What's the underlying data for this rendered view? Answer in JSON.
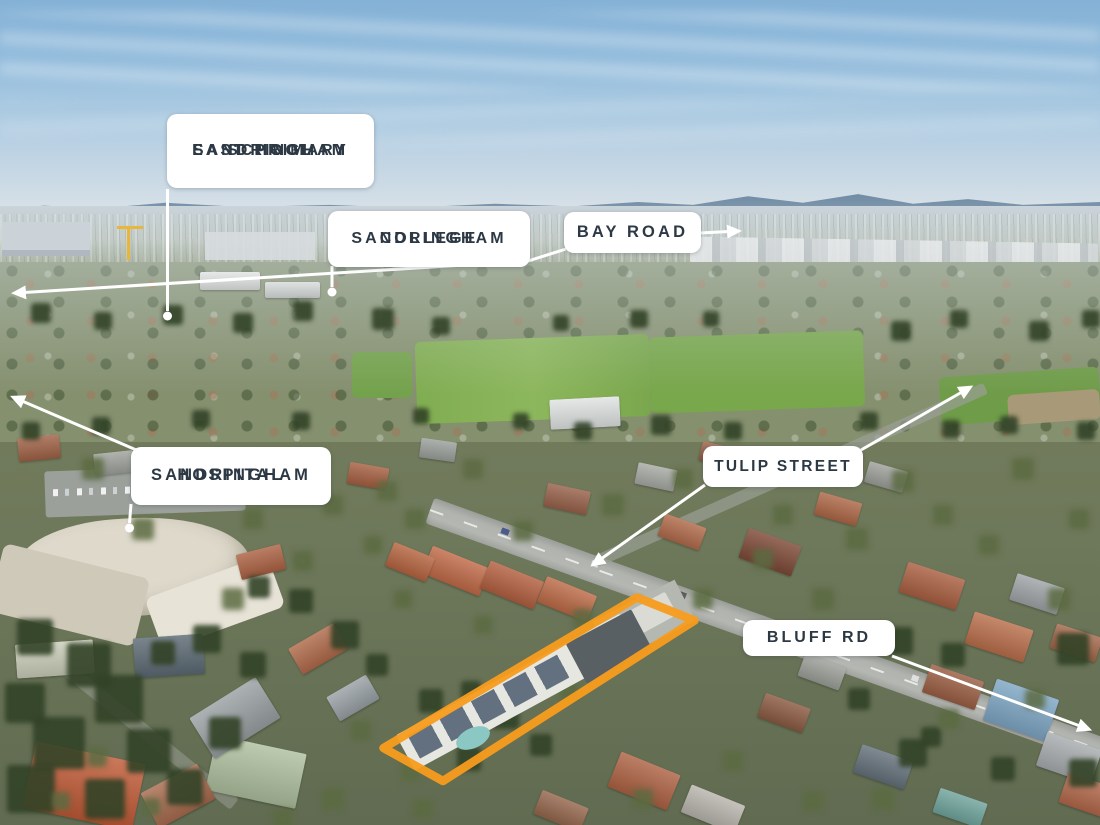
{
  "image": {
    "type": "annotated-aerial-photograph",
    "subject": "suburban location map with points of interest",
    "width": 1100,
    "height": 825
  },
  "labels": {
    "school": {
      "line1": "SANDRINGHAM",
      "line2": "EAST PRIMARY",
      "line3": "SCHOOL"
    },
    "college": {
      "line1": "SANDRINGHAM",
      "line2": "COLLEGE"
    },
    "bay_road": {
      "line1": "BAY ROAD"
    },
    "hospital": {
      "line1": "SANDRINGHAM",
      "line2": "HOSPITAL"
    },
    "tulip_street": {
      "line1": "TULIP STREET"
    },
    "bluff_rd": {
      "line1": "BLUFF RD"
    }
  },
  "colors": {
    "label_bg": "#FFFFFF",
    "label_text": "#2C3945",
    "leader_line": "#FFFFFF",
    "property_outline": "#F89C1E"
  }
}
